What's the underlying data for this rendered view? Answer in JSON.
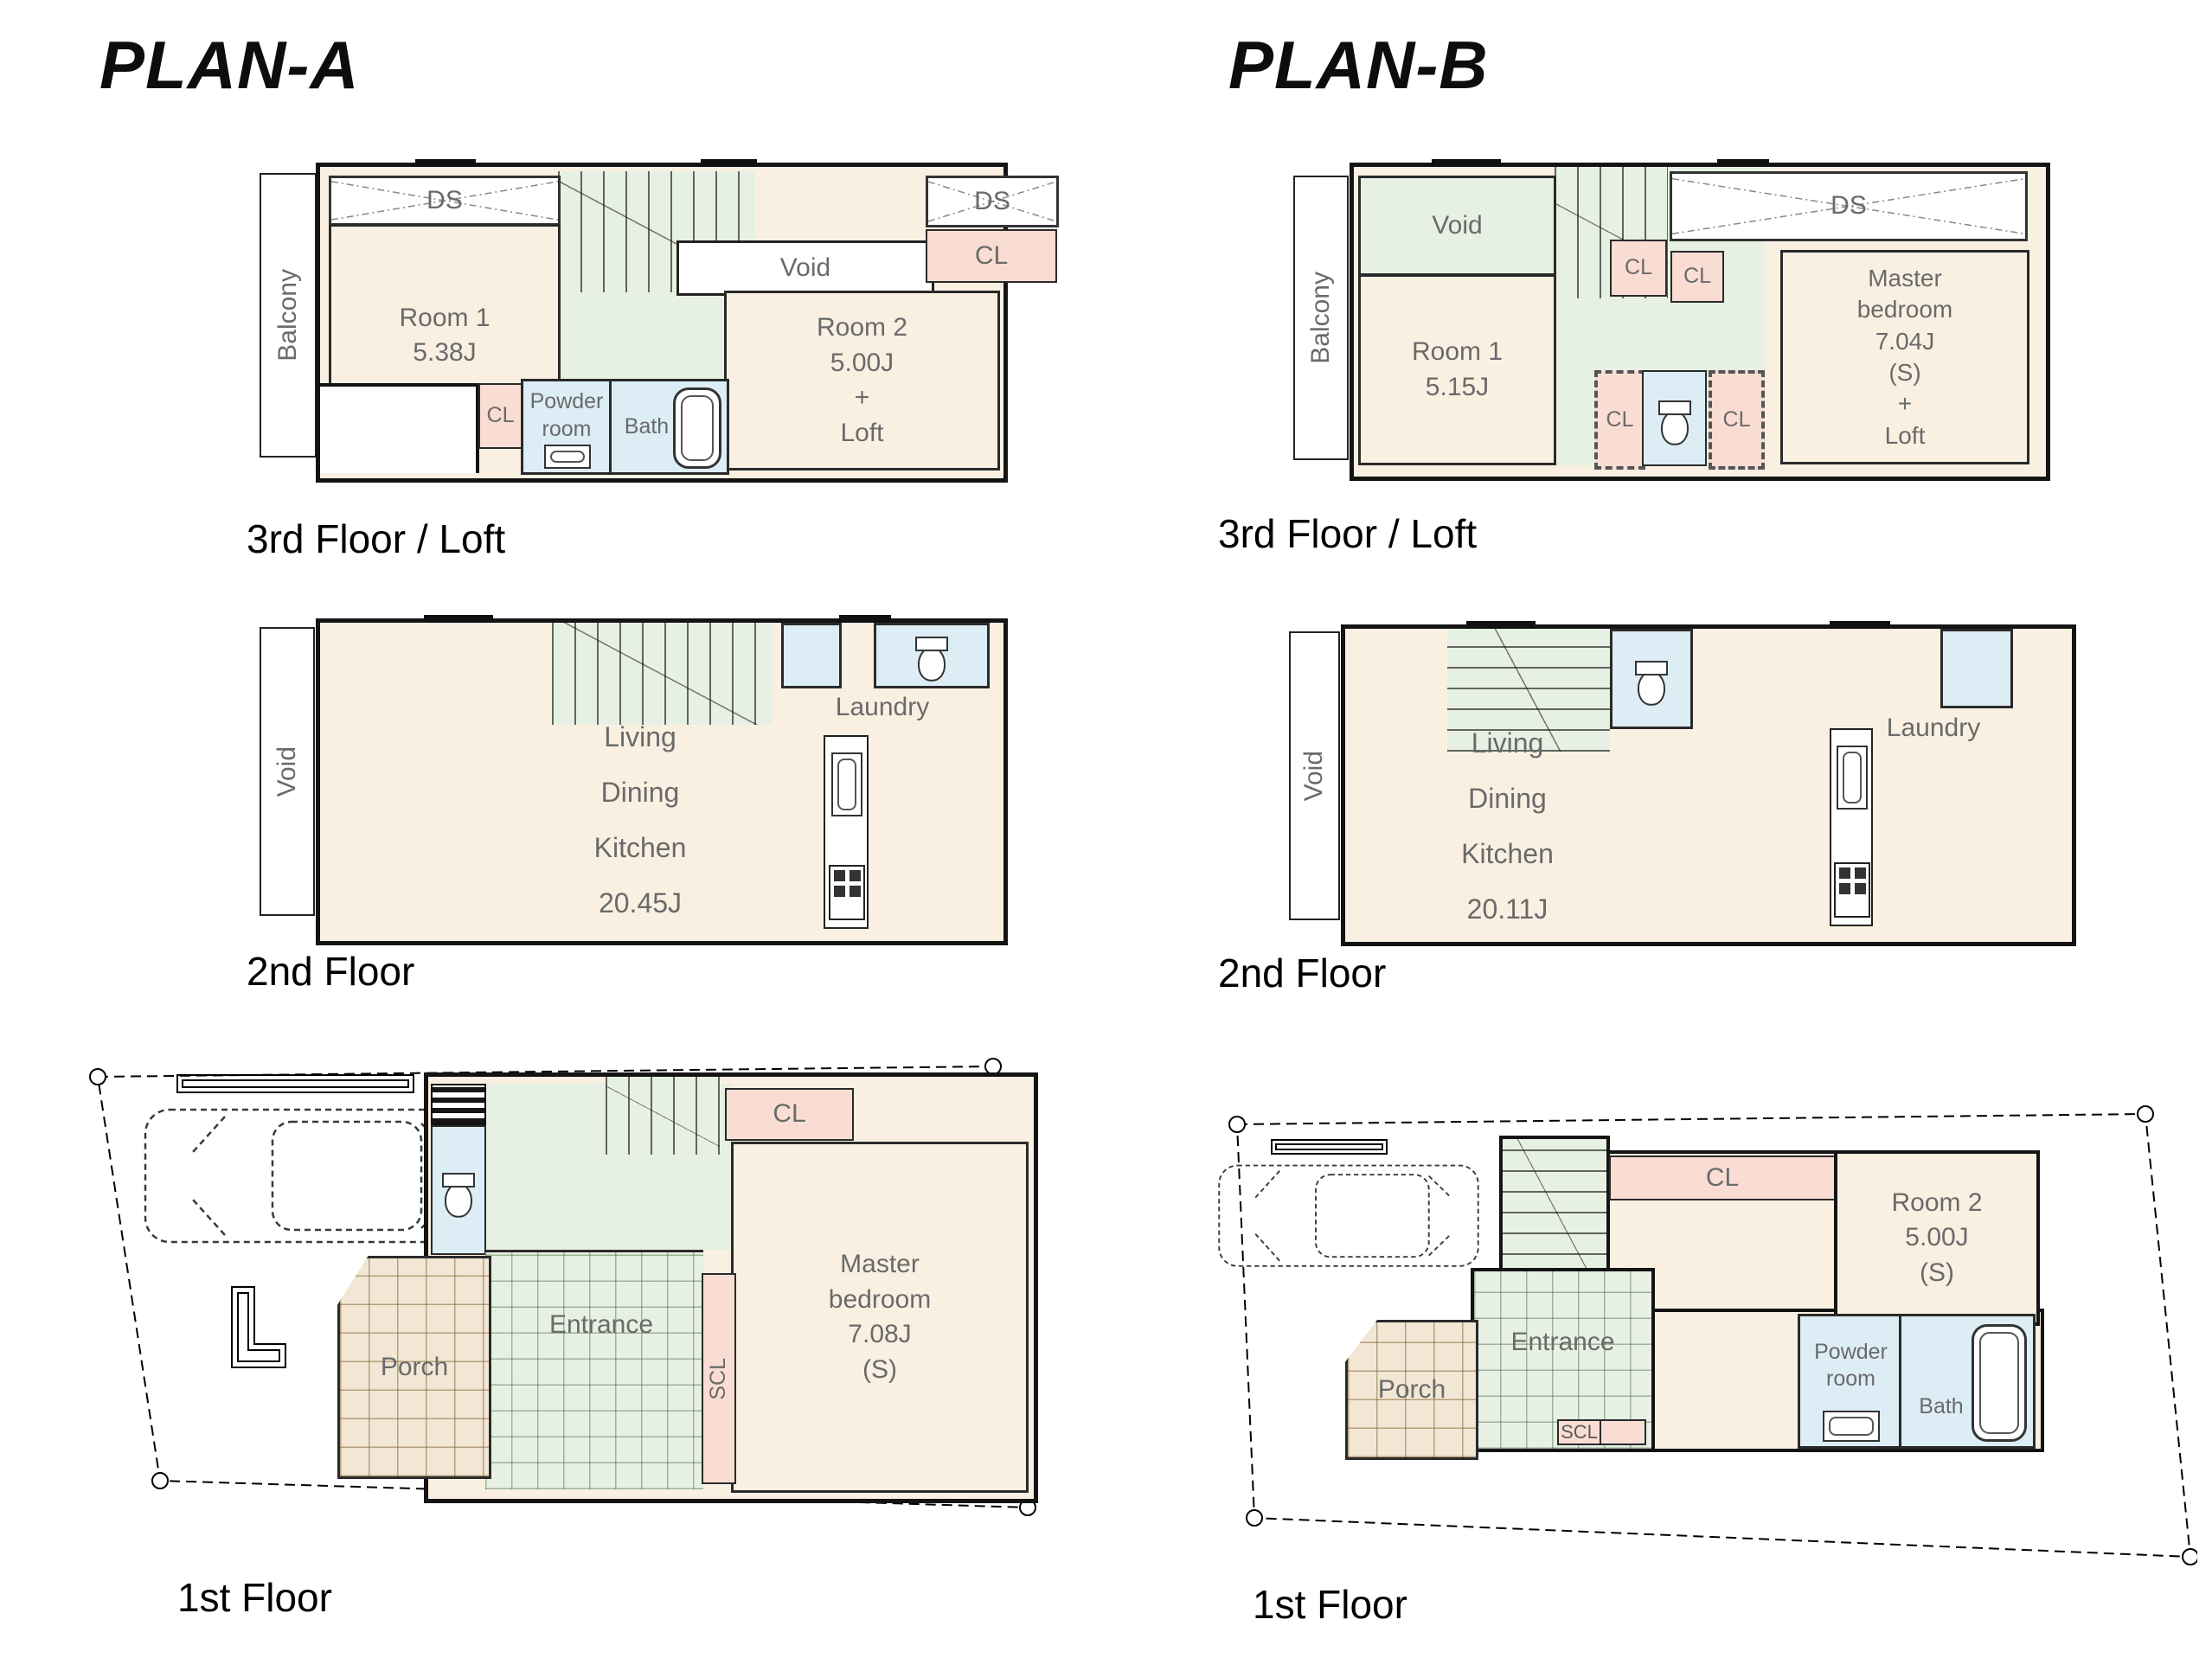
{
  "document": {
    "type": "floor-plan-comparison-sheet"
  },
  "labels": {
    "cl": "CL",
    "scl": "SCL",
    "ds": "DS",
    "void": "Void",
    "balcony": "Balcony",
    "laundry": "Laundry",
    "bath": "Bath",
    "powder_room": "Powder\nroom",
    "porch": "Porch",
    "entrance": "Entrance",
    "floor3": "3rd Floor / Loft",
    "floor2": "2nd Floor",
    "floor1": "1st Floor"
  },
  "plan_a": {
    "title": "PLAN-A",
    "f3": {
      "room1": "Room 1\n5.38J",
      "room2": "Room 2\n5.00J\n+\nLoft"
    },
    "f2": {
      "ldk": "Living\nDining\nKitchen\n20.45J"
    },
    "f1": {
      "master": "Master\nbedroom\n7.08J\n(S)"
    }
  },
  "plan_b": {
    "title": "PLAN-B",
    "f3": {
      "room1": "Room 1\n5.15J",
      "master": "Master\nbedroom\n7.04J\n(S)\n+\nLoft"
    },
    "f2": {
      "ldk": "Living\nDining\nKitchen\n20.11J"
    },
    "f1": {
      "room2": "Room 2\n5.00J\n(S)"
    }
  },
  "colors": {
    "room_fill": "#FAF0E2",
    "closet_fill": "#F9DDD3",
    "wet_fill": "#DCEDF5",
    "hall_fill": "#E7F1E3",
    "porch_fill": "#F2E7D4",
    "wall": "#141414",
    "room_text": "#6A6A6A"
  }
}
